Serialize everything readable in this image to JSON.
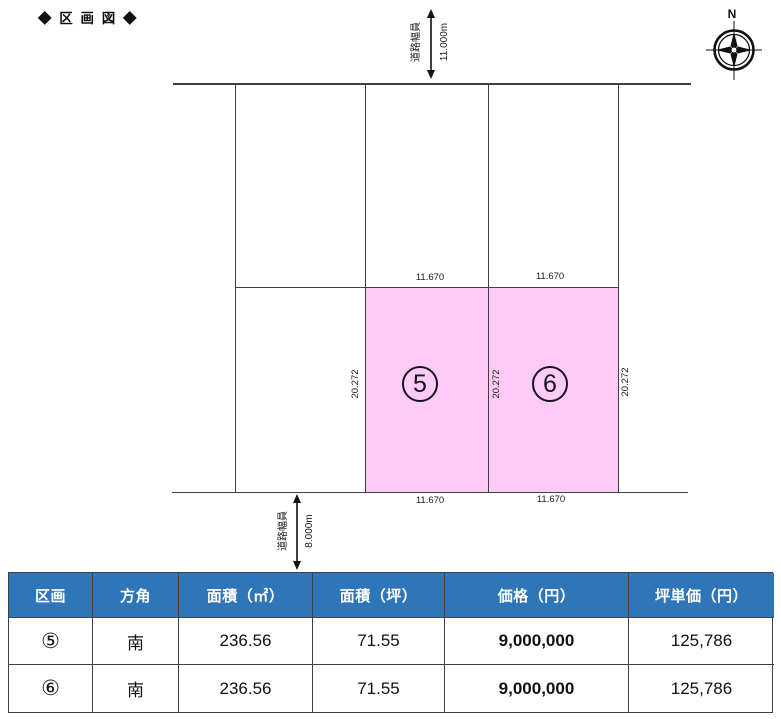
{
  "title": "◆ 区 画 図 ◆",
  "compass": {
    "north_label": "N"
  },
  "colors": {
    "plot_highlight": "#FDCBF6",
    "table_header_bg": "#2F76B8",
    "line": "#404040"
  },
  "diagram": {
    "top_road": {
      "label": "道路幅員",
      "value": "11.000m"
    },
    "bottom_road": {
      "label": "道路幅員",
      "value": "8.000m"
    },
    "plot5": {
      "number": "5",
      "width_top": "11.670",
      "width_bottom": "11.670",
      "depth_left": "20.272"
    },
    "plot6": {
      "number": "6",
      "width_top": "11.670",
      "width_bottom": "11.670",
      "depth_left": "20.272",
      "depth_right": "20.272"
    }
  },
  "table": {
    "headers": [
      "区画",
      "方角",
      "面積（㎡）",
      "面積（坪）",
      "価格（円）",
      "坪単価（円）"
    ],
    "rows": [
      [
        "⑤",
        "南",
        "236.56",
        "71.55",
        "9,000,000",
        "125,786"
      ],
      [
        "⑥",
        "南",
        "236.56",
        "71.55",
        "9,000,000",
        "125,786"
      ]
    ]
  }
}
